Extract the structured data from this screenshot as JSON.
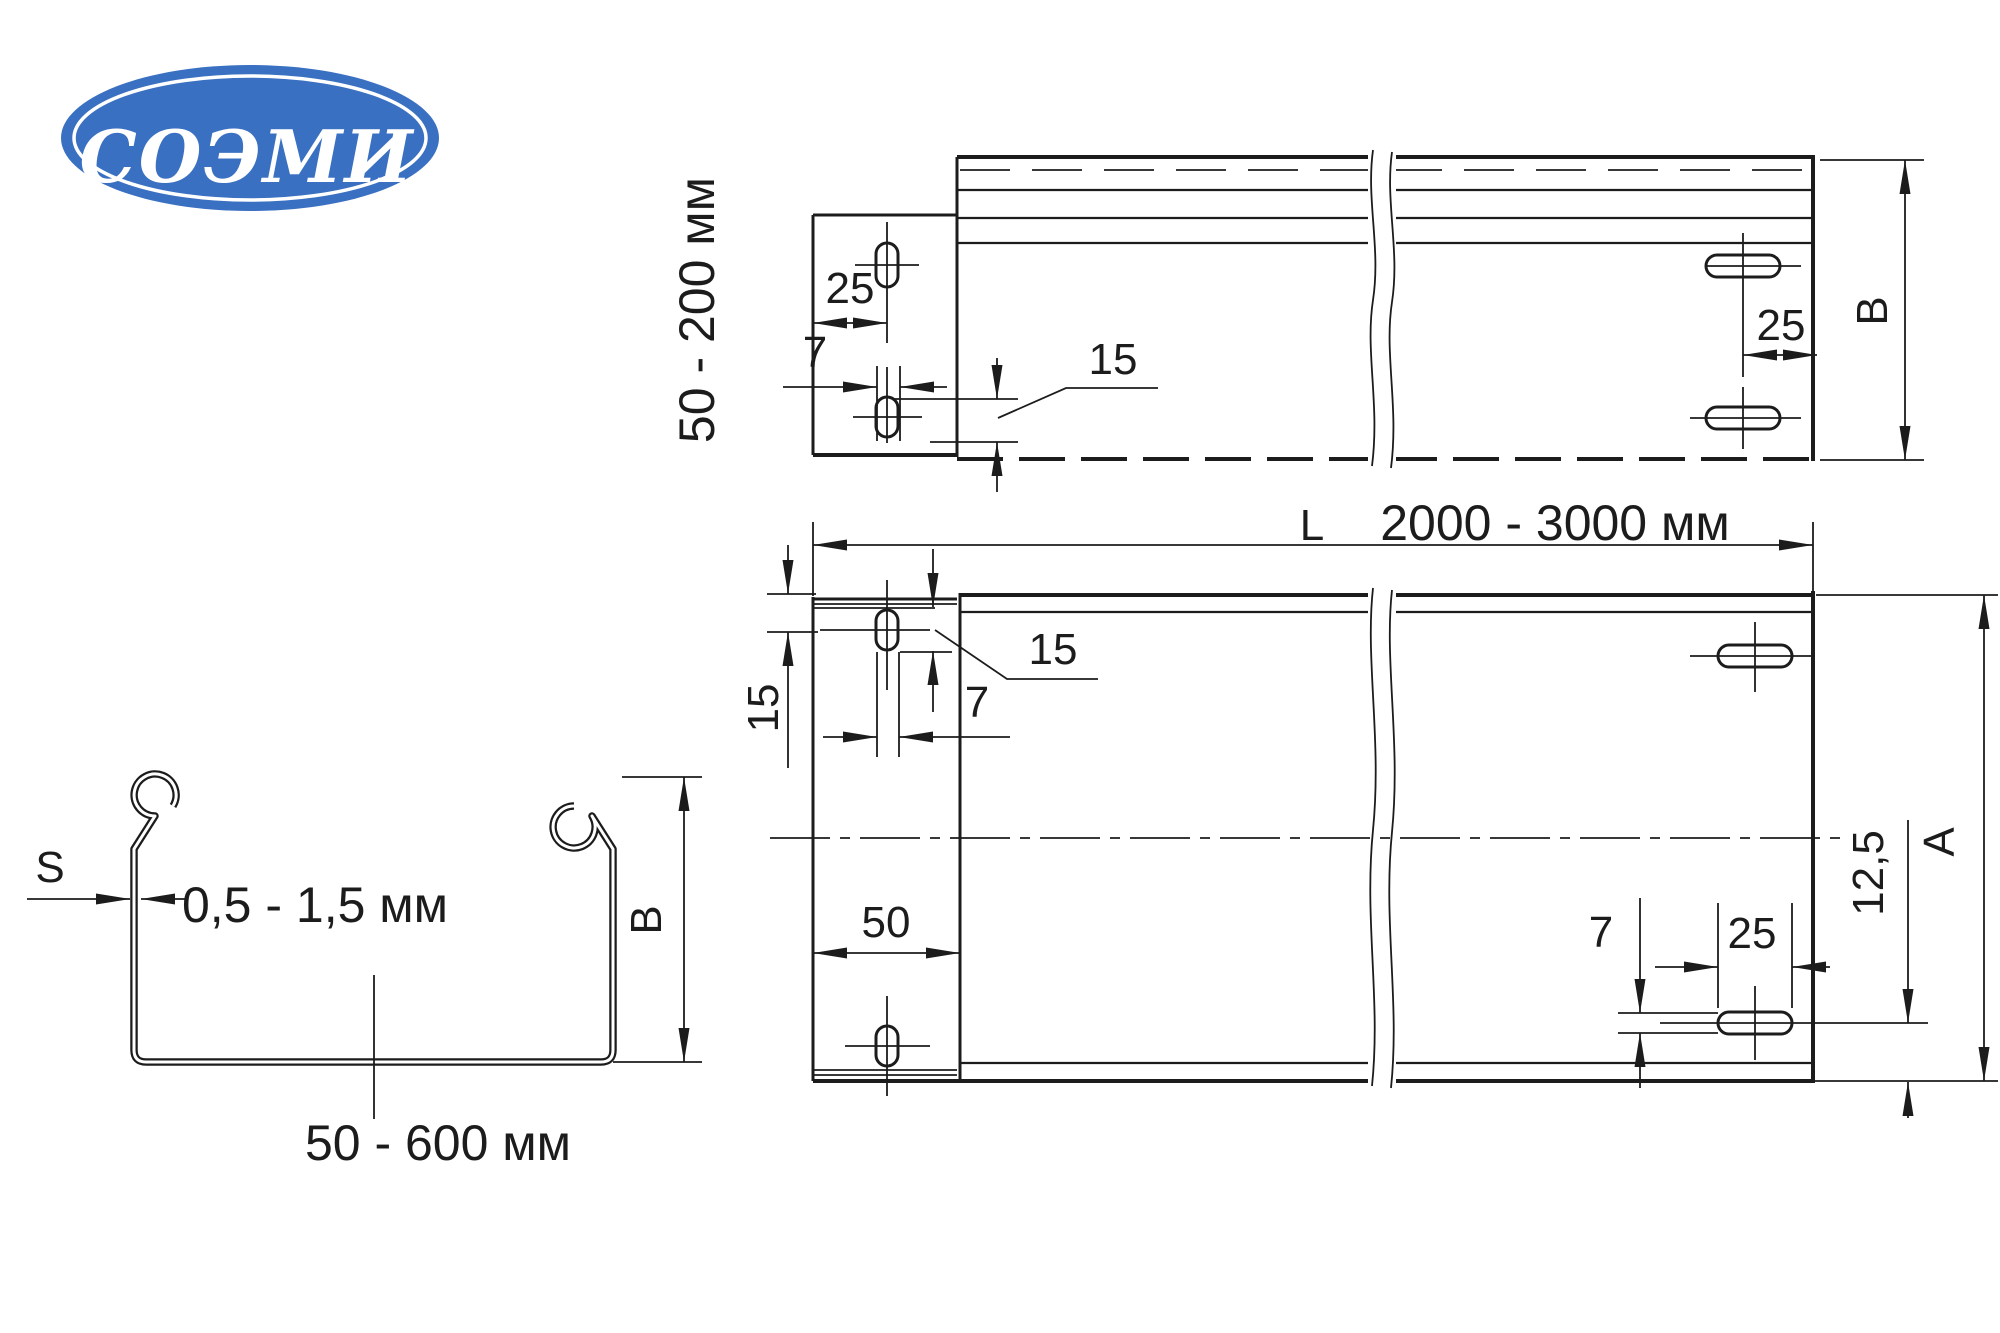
{
  "colors": {
    "line": "#1c1c1c",
    "logo_blue": "#3A70C1",
    "background": "#ffffff"
  },
  "logo": {
    "text": "СОЭМИ"
  },
  "side_view": {
    "height_range": "50 - 200 мм",
    "edge_to_slot": "25",
    "slot_width": "7",
    "slot_length": "15",
    "end_to_slot": "25",
    "height": "B"
  },
  "plan_view": {
    "length_symbol": "L",
    "length_range": "2000 - 3000 мм",
    "edge_to_slot_center": "15",
    "slot_length": "15",
    "slot_width": "7",
    "tab_length": "50",
    "right_slot_width": "7",
    "right_slot_length": "25",
    "slot_center_to_edge": "12,5",
    "width": "A"
  },
  "cross_section": {
    "thickness_symbol": "S",
    "thickness_range": "0,5 - 1,5 мм",
    "height": "B",
    "width_range": "50 - 600 мм"
  }
}
